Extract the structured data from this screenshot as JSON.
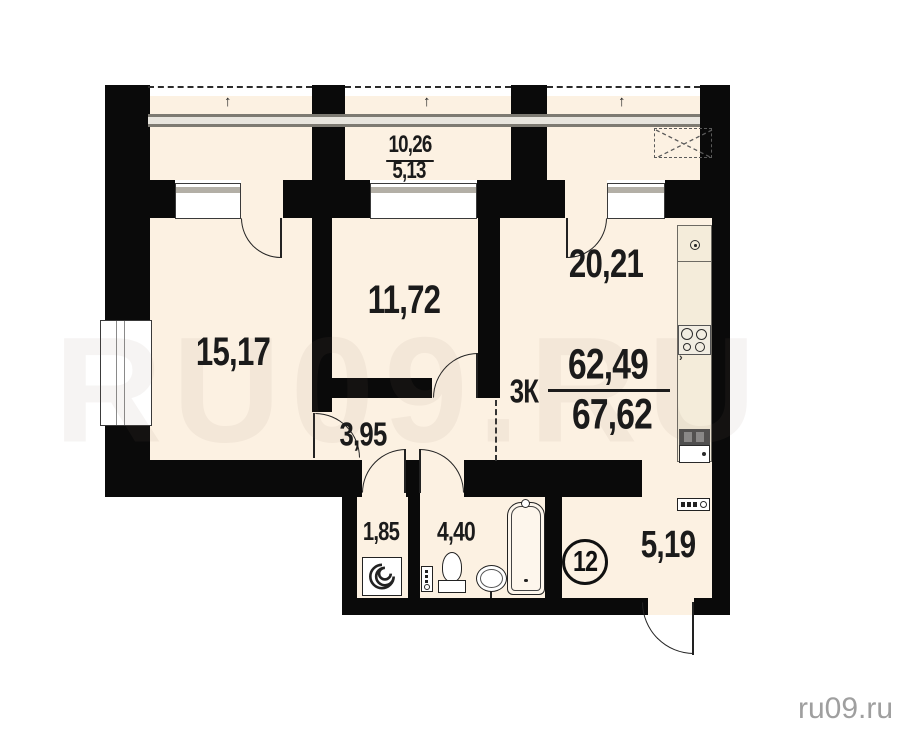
{
  "plan": {
    "unit_number": "12",
    "apartment_type": "3К",
    "area_living": "62,49",
    "area_total": "67,62",
    "rooms": {
      "room1": "15,17",
      "room2": "11,72",
      "kitchen_living": "20,21",
      "hall": "3,95",
      "wc": "1,85",
      "bathroom": "4,40",
      "corridor": "5,19",
      "balcony_total": "10,26",
      "balcony_half": "5,13"
    },
    "glazing_arrow": "↑"
  },
  "watermark": {
    "small": "ru09.ru",
    "large": "RU09.RU"
  },
  "colors": {
    "wall": "#0a0a0a",
    "floor": "#fcf1e2",
    "counter": "#f4ecda",
    "watermark": "#9f9f9f"
  }
}
